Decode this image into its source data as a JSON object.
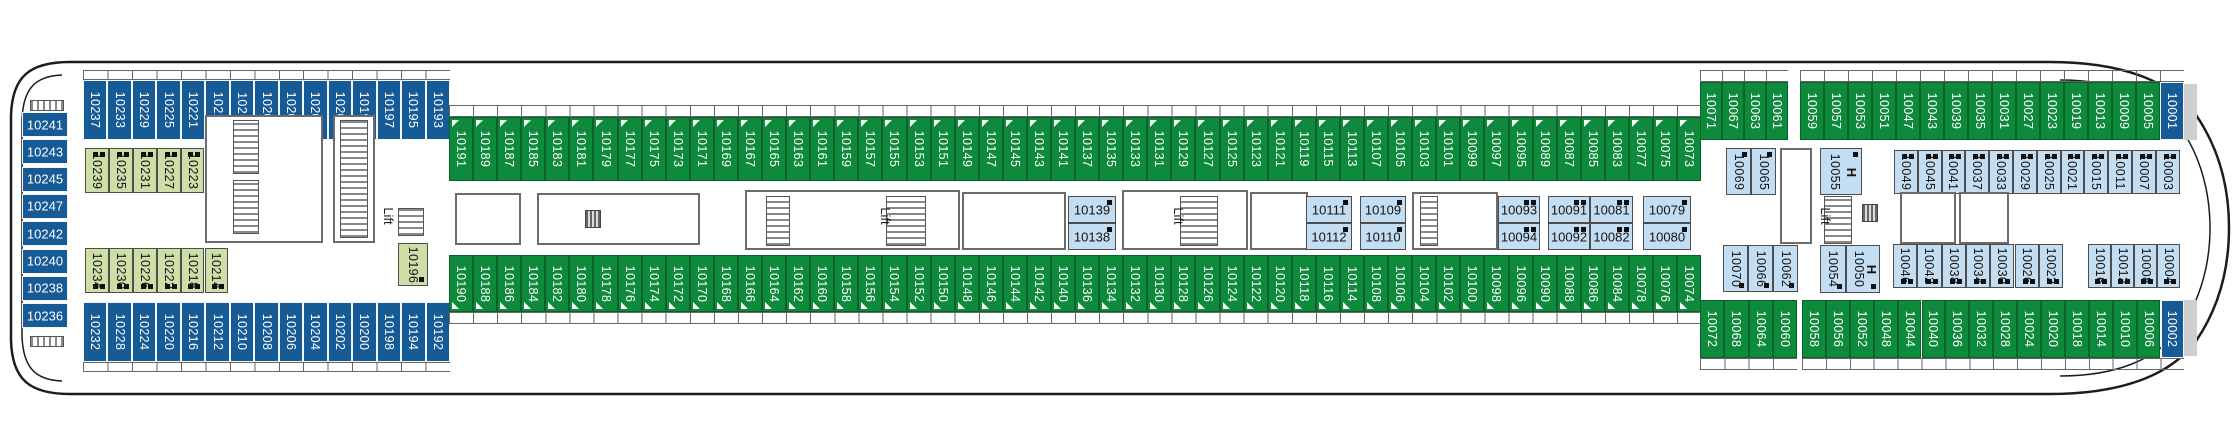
{
  "deck_plan": {
    "lift_label": "Lift",
    "handicap_label": "H",
    "colors": {
      "balcony_green": "#0e8a3c",
      "outside_blue": "#165a96",
      "interior_pale_green": "#cddfa6",
      "interior_pale_blue": "#c3ddf2"
    },
    "rows": {
      "left_stack": [
        "10241",
        "10243",
        "10245",
        "10247",
        "10242",
        "10240",
        "10238",
        "10236"
      ],
      "top_blue": [
        "10237",
        "10233",
        "10229",
        "10225",
        "10221",
        "10215",
        "10211",
        "10207",
        "10205",
        "10203",
        "10201",
        "10199",
        "10197",
        "10195",
        "10193"
      ],
      "top_inner_palegreen": [
        "10239",
        "10235",
        "10231",
        "10227",
        "10223",
        "10219",
        "10213",
        "10209"
      ],
      "bottom_inner_palegreen": [
        "10234",
        "10230",
        "10226",
        "10222",
        "10218",
        "10214"
      ],
      "bottom_blue": [
        "10232",
        "10228",
        "10224",
        "10220",
        "10216",
        "10212",
        "10210",
        "10208",
        "10206",
        "10204",
        "10202",
        "10200",
        "10198",
        "10194",
        "10192"
      ],
      "top_green": [
        "10191",
        "10189",
        "10187",
        "10185",
        "10183",
        "10181",
        "10179",
        "10177",
        "10175",
        "10173",
        "10171",
        "10169",
        "10167",
        "10165",
        "10163",
        "10161",
        "10159",
        "10157",
        "10155",
        "10153",
        "10151",
        "10149",
        "10147",
        "10145",
        "10143",
        "10141",
        "10137",
        "10135",
        "10133",
        "10131",
        "10129",
        "10127",
        "10125",
        "10123",
        "10121",
        "10119",
        "10115",
        "10113",
        "10107",
        "10105",
        "10103",
        "10101",
        "10099",
        "10097",
        "10095",
        "10089",
        "10087",
        "10085",
        "10083",
        "10077",
        "10075",
        "10073"
      ],
      "bottom_green": [
        "10190",
        "10188",
        "10186",
        "10184",
        "10182",
        "10180",
        "10178",
        "10176",
        "10174",
        "10172",
        "10170",
        "10168",
        "10166",
        "10164",
        "10162",
        "10160",
        "10158",
        "10156",
        "10154",
        "10152",
        "10150",
        "10148",
        "10146",
        "10144",
        "10142",
        "10140",
        "10136",
        "10134",
        "10132",
        "10130",
        "10128",
        "10126",
        "10124",
        "10122",
        "10120",
        "10118",
        "10116",
        "10114",
        "10108",
        "10106",
        "10104",
        "10102",
        "10100",
        "10098",
        "10096",
        "10090",
        "10088",
        "10086",
        "10084",
        "10078",
        "10076",
        "10074"
      ],
      "top_right_green_a": [
        "10071",
        "10067",
        "10063",
        "10061"
      ],
      "top_right_green_b": [
        "10059",
        "10057",
        "10053",
        "10051",
        "10047",
        "10043",
        "10039",
        "10035",
        "10031",
        "10027",
        "10023",
        "10019",
        "10013",
        "10009",
        "10005",
        "10001"
      ],
      "top_right_inner_blue": [
        "10049",
        "10045",
        "10041",
        "10037",
        "10033",
        "10029",
        "10025",
        "10021",
        "10015",
        "10011",
        "10007",
        "10003"
      ],
      "bottom_right_inner_blue_a": [
        "10046",
        "10042",
        "10038",
        "10034",
        "10030",
        "10026",
        "10022"
      ],
      "bottom_right_inner_blue_b": [
        "10016",
        "10012",
        "10008",
        "10004"
      ],
      "bottom_right_green_a": [
        "10072",
        "10068",
        "10064",
        "10060"
      ],
      "bottom_right_green_b": [
        "10058",
        "10056",
        "10052",
        "10048",
        "10044",
        "10040",
        "10036",
        "10032",
        "10028",
        "10024",
        "10020",
        "10018",
        "10014",
        "10010",
        "10006",
        "10002"
      ]
    },
    "interior": {
      "single_inside": "10196",
      "mid_pairs": [
        {
          "top": "10139",
          "bottom": "10138"
        },
        {
          "top": "10111",
          "bottom": "10112"
        },
        {
          "top": "10109",
          "bottom": "10110"
        },
        {
          "top": "10093",
          "bottom": "10094"
        },
        {
          "top": "10091",
          "bottom": "10092"
        },
        {
          "top": "10081",
          "bottom": "10082"
        },
        {
          "top": "10079",
          "bottom": "10080"
        }
      ],
      "right_top_vertical": [
        "10069",
        "10065"
      ],
      "right_top_handicap": "10055",
      "right_bottom_vertical": [
        "10070",
        "10066",
        "10062"
      ],
      "right_bottom_plain": "10054",
      "right_bottom_handicap": "10050"
    }
  }
}
